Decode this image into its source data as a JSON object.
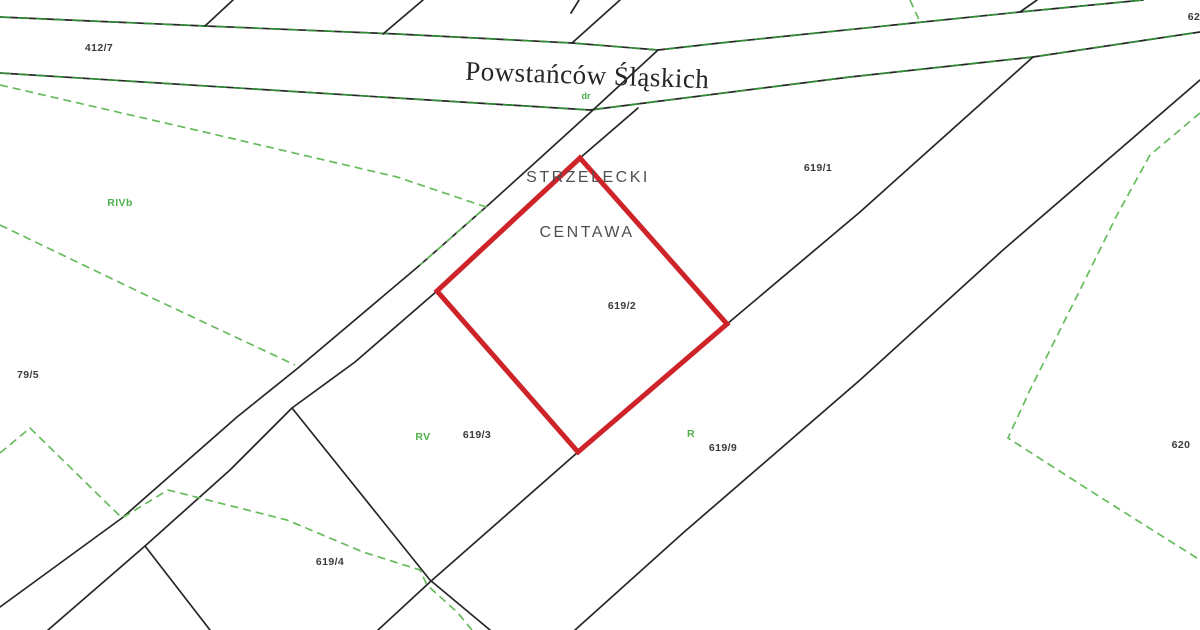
{
  "map": {
    "canvas": {
      "width": 1200,
      "height": 630,
      "background": "#ffffff"
    },
    "colors": {
      "boundary_line": "#262626",
      "street_green_overlay": "#2f9133",
      "classification_dash": "#66bb5c",
      "highlight_red": "#cd2329",
      "parcel_label": "#3b3b3b",
      "soil_label": "#4db04a",
      "district_label": "#4f4f4f",
      "street_label": "#262626"
    },
    "street_label": {
      "text": "Powstańców Śląskich",
      "x": 587,
      "y": 84,
      "rotation": 2
    },
    "road_class_label": {
      "text": "dr",
      "x": 586,
      "y": 99
    },
    "district_labels": [
      {
        "name": "district-strzelecki",
        "text": "STRZELECKI",
        "x": 588,
        "y": 182
      },
      {
        "name": "district-centawa",
        "text": "CENTAWA",
        "x": 587,
        "y": 237
      }
    ],
    "highlighted_parcel": {
      "number": "619/2",
      "points": "580,158 727,324 578,452 437,291",
      "color": "#cd2329",
      "label_x": 622,
      "label_y": 309
    },
    "parcel_labels": [
      {
        "text": "412/7",
        "x": 99,
        "y": 51
      },
      {
        "text": "62",
        "x": 1194,
        "y": 20
      },
      {
        "text": "619/1",
        "x": 818,
        "y": 171
      },
      {
        "text": "619/3",
        "x": 477,
        "y": 438
      },
      {
        "text": "619/9",
        "x": 723,
        "y": 451
      },
      {
        "text": "619/4",
        "x": 330,
        "y": 565
      },
      {
        "text": "620",
        "x": 1181,
        "y": 448
      },
      {
        "text": "79/5",
        "x": 28,
        "y": 378
      }
    ],
    "soil_class_labels": [
      {
        "text": "RIVb",
        "x": 120,
        "y": 206
      },
      {
        "text": "RV",
        "x": 423,
        "y": 440
      },
      {
        "text": "R",
        "x": 691,
        "y": 437
      }
    ],
    "boundary_lines": [
      {
        "name": "street-north-edge",
        "points": "0,17 205,26 397,34 572,43 658,50 720,43 1020,12 1143,0",
        "green_overlay": true
      },
      {
        "name": "street-south-edge",
        "points": "0,73 397,98 590,110 850,77 1033,57 1200,32",
        "green_overlay": true
      },
      {
        "name": "north-branch-1",
        "points": "205,26 233,0"
      },
      {
        "name": "north-branch-2",
        "points": "383,34 423,0"
      },
      {
        "name": "north-branch-3",
        "points": "572,43 620,0"
      },
      {
        "name": "north-stub",
        "points": "571,13 579,0"
      },
      {
        "name": "north-fork-branch",
        "points": "1020,12 1037,0"
      },
      {
        "name": "road-northwest-edge",
        "points": "0,607 122,518 237,417 298,368 420,265 486,207 538,160 593,110 658,50"
      },
      {
        "name": "road-southeast-edge",
        "points": "48,630 145,546 230,470 292,408 355,362 437,291 580,158 638,108"
      },
      {
        "name": "parcel-619-3-south-boundary",
        "points": "292,408 430,580 490,630"
      },
      {
        "name": "southwest-branch",
        "points": "145,546 210,630"
      },
      {
        "name": "parcel-619-9-northwest-boundary",
        "points": "1033,57 860,212 727,324 578,452 430,582 378,630"
      },
      {
        "name": "parcel-619-9-southeast-boundary",
        "points": "1200,80 1003,250 860,380 683,533 575,630"
      }
    ],
    "class_dash_lines": [
      {
        "name": "class-dash-northwest",
        "points": "0,85 200,131 397,177 486,207 420,265"
      },
      {
        "name": "class-dash-west",
        "points": "0,225 150,297 295,365"
      },
      {
        "name": "class-dash-southwest",
        "points": "0,453 30,428 122,518 168,490 287,520 363,552 420,570 427,585 457,612 472,630"
      },
      {
        "name": "class-dash-east",
        "points": "1200,113 1150,155 1117,215 1080,290 1030,390 1008,438 1100,497 1200,560"
      },
      {
        "name": "class-dash-north",
        "points": "910,0 920,22"
      }
    ]
  }
}
